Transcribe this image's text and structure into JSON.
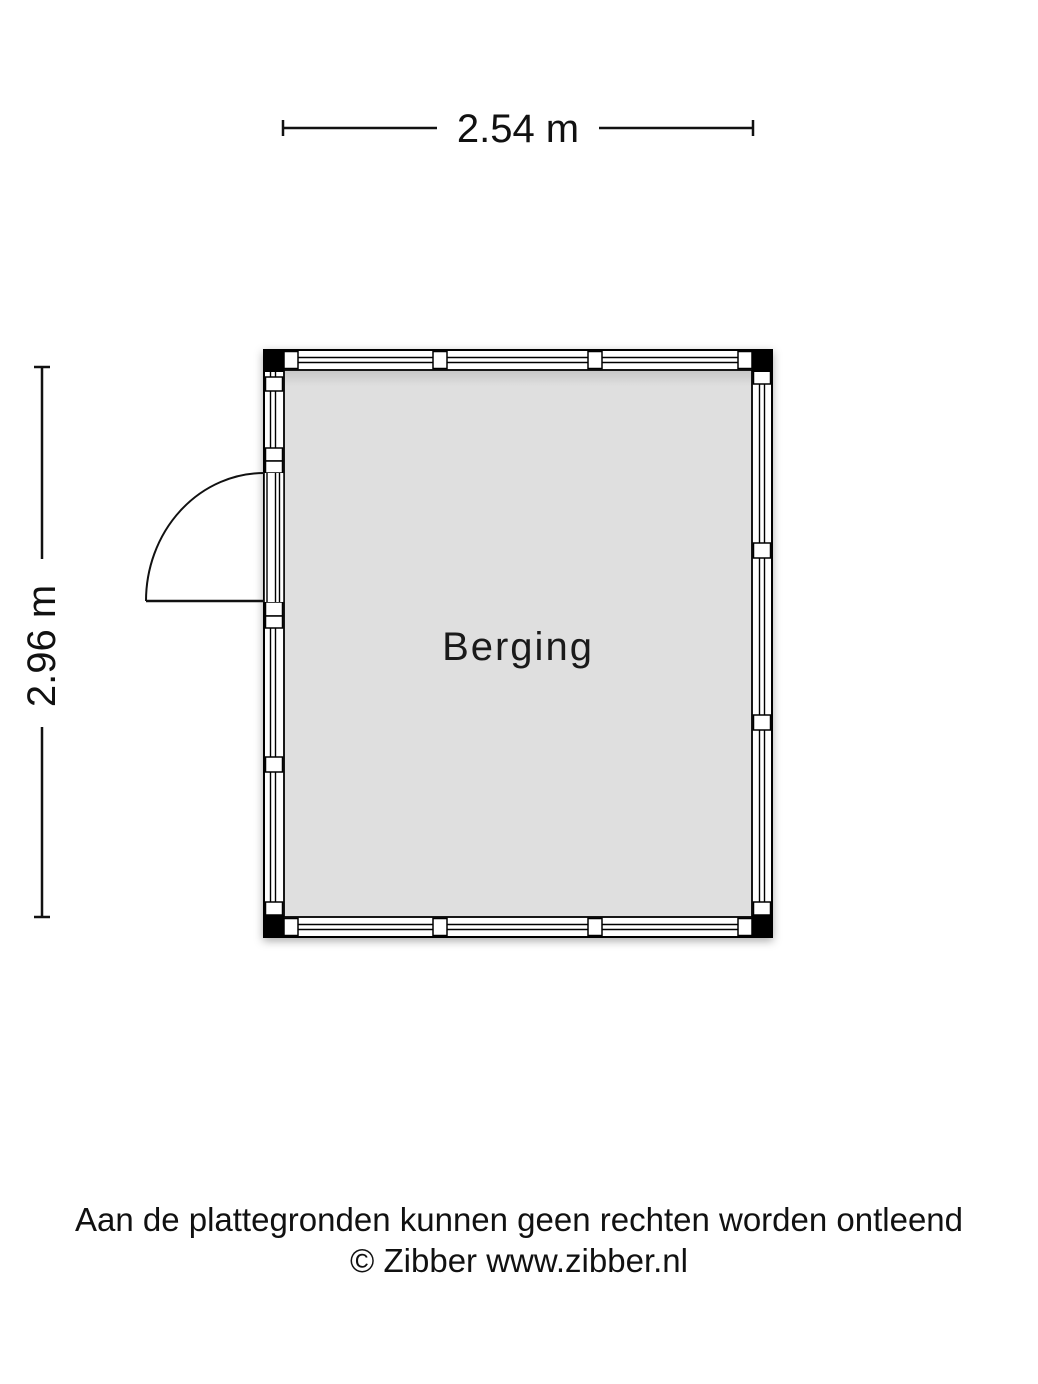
{
  "floorplan": {
    "room": {
      "label": "Berging"
    },
    "dimensions": {
      "width_label": "2.54 m",
      "height_label": "2.96 m"
    },
    "colors": {
      "line": "#000000",
      "wall_fill": "#ffffff",
      "room_fill": "#dfdfdf",
      "corner_post": "#000000"
    }
  },
  "footer": {
    "line1": "Aan de plattegronden kunnen geen rechten worden ontleend",
    "line2": "© Zibber www.zibber.nl"
  }
}
